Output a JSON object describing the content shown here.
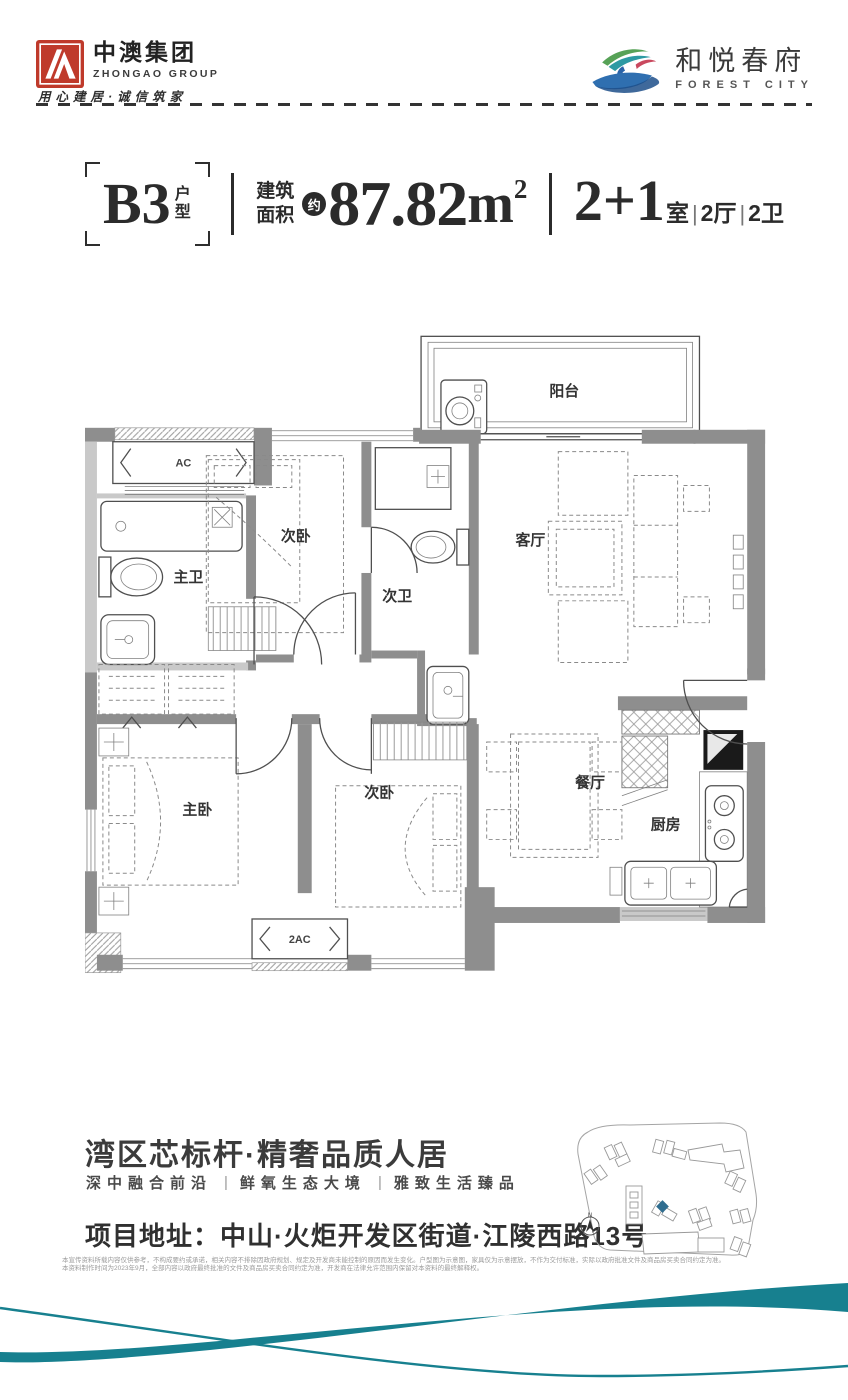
{
  "header": {
    "logo_left": {
      "name": "中澳集团",
      "name_en": "ZHONGAO GROUP",
      "slogan": "用心建居·诚信筑家"
    },
    "logo_right": {
      "name": "和悦春府",
      "name_en": "FOREST CITY"
    }
  },
  "title_bar": {
    "unit": "B3",
    "unit_suffix_1": "户",
    "unit_suffix_2": "型",
    "area_label_1": "建筑",
    "area_label_2": "面积",
    "approx": "约",
    "area_value": "87.82",
    "area_unit": "m",
    "area_sup": "2",
    "rooms_main": "2+1",
    "rooms_main_unit": "室",
    "rooms_sep": "|",
    "rooms_hall": "2厅",
    "rooms_bath": "2卫"
  },
  "floorplan": {
    "rooms": {
      "balcony": "阳台",
      "ac": "AC",
      "master_bath": "主卫",
      "bedroom2_top": "次卧",
      "bath2": "次卫",
      "living": "客厅",
      "master_bedroom": "主卧",
      "bedroom2_bottom": "次卧",
      "dining": "餐厅",
      "kitchen": "厨房",
      "ac2": "2AC"
    }
  },
  "tagline": {
    "headline": "湾区芯标杆·精奢品质人居",
    "sub_points": [
      "深中融合前沿",
      "鲜氧生态大境",
      "雅致生活臻品"
    ],
    "sub_separator": "|",
    "address": "项目地址：中山·火炬开发区街道·江陵西路13号"
  },
  "sitemap": {
    "compass_label": "N"
  },
  "disclaimer": {
    "line1": "本宣传资料所载内容仅供参考，不构成要约或承诺，相关内容不排除因政府规划、规定及开发商未能控制的原因而发生变化。户型图为示意图，家具仅为示意摆放，不作为交付标准，实际以政府批准文件及商品房买卖合同约定为准。",
    "line2": "本资料制作时间为2023年9月，全部内容以政府最终批准的文件及商品房买卖合同约定为准，开发商在法律允许范围内保留对本资料的最终解释权。"
  },
  "colors": {
    "accent_teal": "#17808f",
    "brand_red": "#bf3a2b",
    "ink": "#2b2b2b"
  }
}
